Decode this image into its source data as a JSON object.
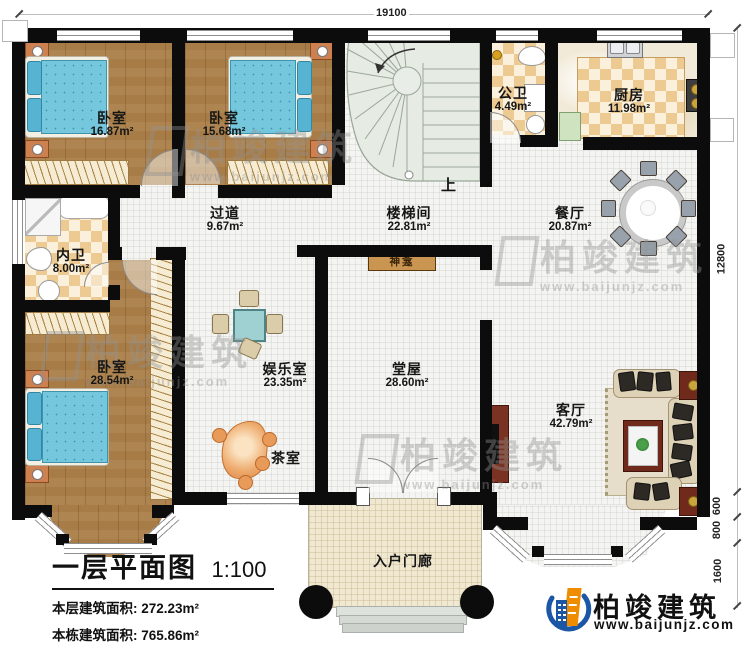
{
  "header": {
    "top_dimension": "19100"
  },
  "side_dimensions": {
    "height_main": "12800",
    "seg_600": "600",
    "seg_800": "800",
    "seg_1600": "1600"
  },
  "rooms": [
    {
      "name": "卧室",
      "area": "16.87m²"
    },
    {
      "name": "卧室",
      "area": "15.68m²"
    },
    {
      "name": "公卫",
      "area": "4.49m²"
    },
    {
      "name": "厨房",
      "area": "11.98m²"
    },
    {
      "name": "过道",
      "area": "9.67m²"
    },
    {
      "name": "楼梯间",
      "area": "22.81m²"
    },
    {
      "name": "餐厅",
      "area": "20.87m²"
    },
    {
      "name": "内卫",
      "area": "8.00m²"
    },
    {
      "name": "卧室",
      "area": "28.54m²"
    },
    {
      "name": "娱乐室",
      "area": "23.35m²"
    },
    {
      "name": "堂屋",
      "area": "28.60m²"
    },
    {
      "name": "客厅",
      "area": "42.79m²"
    },
    {
      "name": "茶室",
      "area": ""
    },
    {
      "name": "入户门廊",
      "area": ""
    }
  ],
  "labels": {
    "shrine": "神龛",
    "stairs_up": "上"
  },
  "title_block": {
    "title": "一层平面图",
    "scale": "1:100",
    "stats": [
      {
        "label": "本层建筑面积:",
        "value": "272.23m²"
      },
      {
        "label": "本栋建筑面积:",
        "value": "765.86m²"
      },
      {
        "label": "占地面积:",
        "value": "280.00m²"
      },
      {
        "label": "层高:",
        "value": "3.6m"
      }
    ]
  },
  "brand": {
    "name": "柏竣建筑",
    "website": "www.baijunjz.com"
  },
  "watermark": {
    "name": "柏竣建筑",
    "website": "www.baijunjz.com"
  },
  "colors": {
    "wall": "#0c0c0c",
    "wood_floor": "#a87c46",
    "tile_floor": "#f4f4f2",
    "checker_tan": "#ecca92",
    "bed_blue": "#74c7dc",
    "stair_green": "#e6ebe4",
    "brand_blue": "#1c57a5",
    "brand_orange": "#f08c00"
  }
}
